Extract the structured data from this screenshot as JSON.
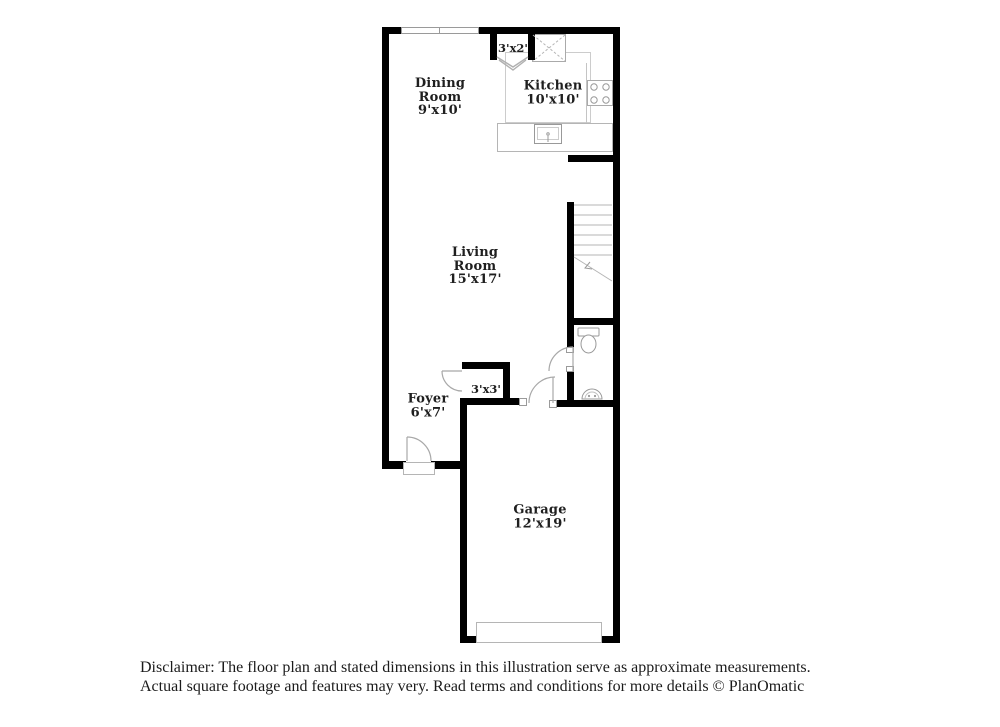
{
  "document_type": "floor-plan-illustration",
  "colors": {
    "wall": "#000000",
    "thin_line": "#b5b5b5",
    "label_text": "#1f1f1f",
    "background": "#ffffff"
  },
  "rooms": {
    "dining": {
      "line1": "Dining",
      "line2": "Room",
      "dims": "9'x10'"
    },
    "kitchen": {
      "line1": "Kitchen",
      "dims": "10'x10'"
    },
    "living": {
      "line1": "Living",
      "line2": "Room",
      "dims": "15'x17'"
    },
    "foyer": {
      "line1": "Foyer",
      "dims": "6'x7'"
    },
    "garage": {
      "line1": "Garage",
      "dims": "12'x19'"
    },
    "hall_closet": {
      "dims": "3'x2'"
    },
    "foyer_closet": {
      "dims": "3'x3'"
    }
  },
  "fixtures": [
    "window",
    "refrigerator",
    "stove",
    "kitchen-island-sink",
    "bifold-closet-door",
    "staircase",
    "toilet",
    "bathroom-sink",
    "front-door-swing",
    "front-door-sill",
    "closet-door-swing",
    "garage-entry-door-swing",
    "bathroom-door-swing",
    "garage-door"
  ],
  "disclaimer": {
    "line1": "Disclaimer: The floor plan and stated dimensions in this illustration serve as approximate measurements.",
    "line2": "Actual square footage and features may very. Read terms and conditions for more details © PlanOmatic"
  }
}
